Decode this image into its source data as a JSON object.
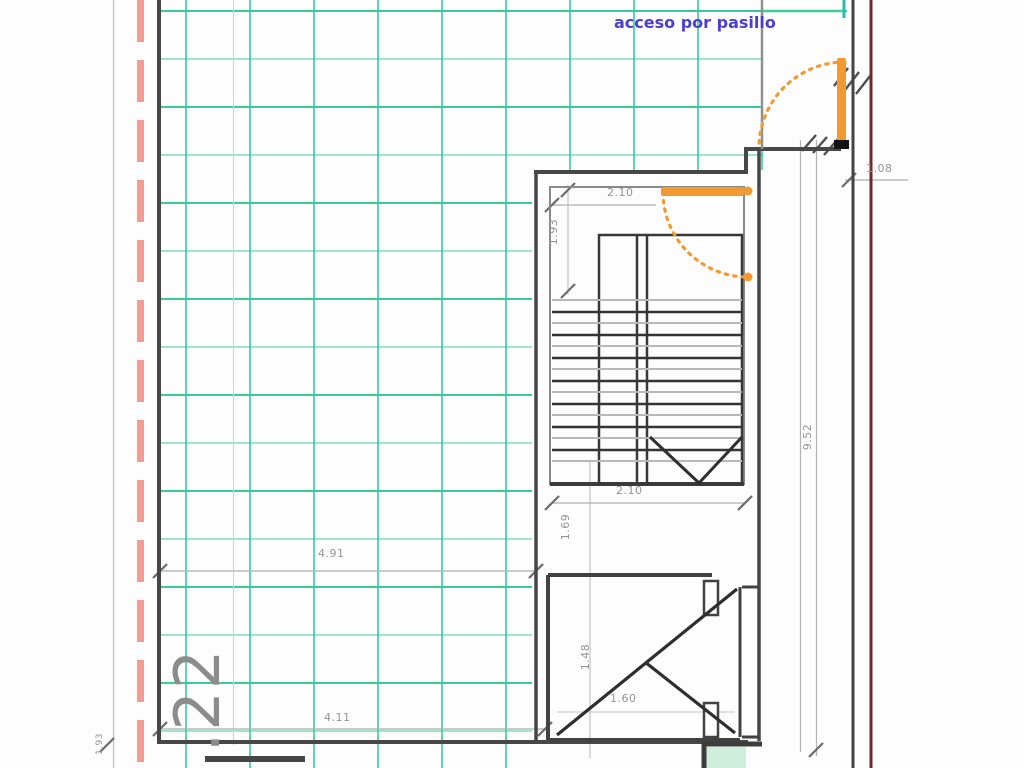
{
  "labels": {
    "access": "acceso por pasillo",
    "unit_number": ".22"
  },
  "dimensions": {
    "stair_top_width": "2.10",
    "stair_upper_run": "1.93",
    "stair_bottom_width": "2.10",
    "stair_lower_landing": "1.69",
    "shaft_depth": "1.48",
    "shaft_width": "1.60",
    "room_width_mid": "4.91",
    "room_width_bottom": "4.11",
    "right_total_height": "9.52",
    "entry_door_width": "1.08",
    "left_bottom_small": "1.93"
  },
  "colors": {
    "grid_green": "#2dc896",
    "boundary_red_dashed": "#f49c94",
    "property_line_maroon": "#6b2a2a",
    "door_orange": "#f29a30",
    "access_label_blue": "#4b3fd0",
    "wall_gray": "#474747",
    "teal_fill": "#cfeede"
  }
}
